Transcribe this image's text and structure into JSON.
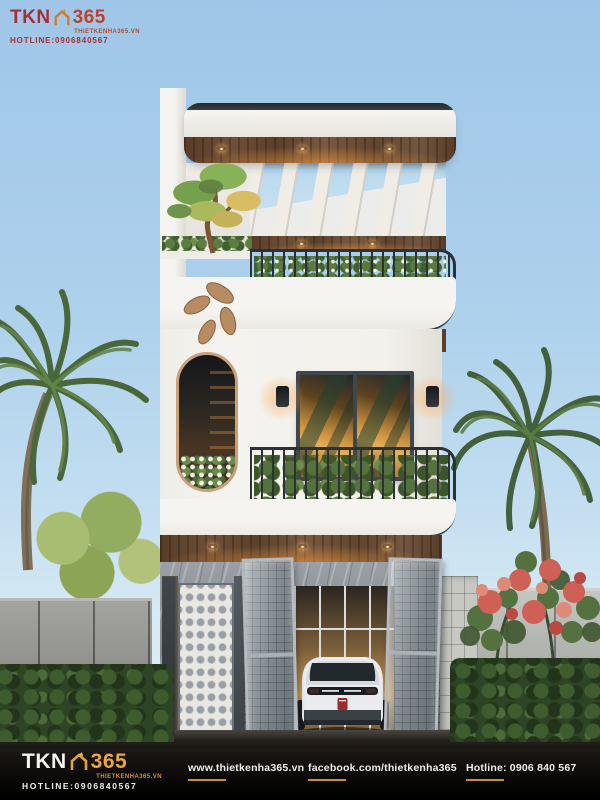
{
  "watermark_top": {
    "brand_tkn": "TKN",
    "brand_365": "365",
    "tagline": "THIETKENHA365.VN",
    "hotline": "HOTLINE:0906840567",
    "color": "#a9262a",
    "icon": "house-outline-icon"
  },
  "footer": {
    "brand_tkn": "TKN",
    "brand_365": "365",
    "tagline": "THIETKENHA365.VN",
    "hotline": "HOTLINE:0906840567",
    "links": {
      "website": "www.thietkenha365.vn",
      "facebook": "facebook.com/thietkenha365",
      "hotline": "Hotline: 0906 840 567"
    },
    "accent": "#c98f33",
    "background": "#0b0908",
    "icon": "house-outline-icon"
  },
  "scene": {
    "type": "architectural-render",
    "subject": "three-storey modern white townhouse with wood soffits, rooftop pergola, plant balconies, oval window, white SUV in carport, palm trees and fences",
    "colors": {
      "sky_top": "#9fc6e8",
      "sky_horizon": "#e3eef5",
      "wall_white": "#f3f1ed",
      "wood": "#6b4c34",
      "railing": "#2c3136",
      "warm_light": "#e5a455",
      "foliage": "#55713d",
      "flower_bush": "#cf6055",
      "fence": "#a3a49f",
      "ground": "#12100d"
    }
  }
}
